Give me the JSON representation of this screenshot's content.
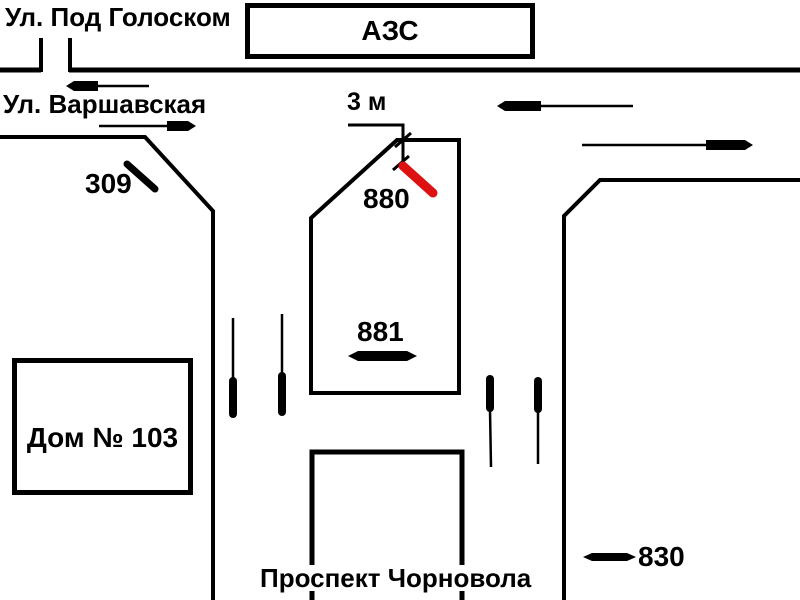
{
  "labels": {
    "street_top": "Ул. Под Голоском",
    "street_left": "Ул. Варшавская",
    "gas_station": "АЗС",
    "dimension": "3 м",
    "house": "Дом № 103",
    "avenue": "Проспект Чорновола"
  },
  "billboards": [
    {
      "id": "309",
      "orientation": "diagonal",
      "color": "#000000",
      "highlighted": false
    },
    {
      "id": "880",
      "orientation": "diagonal",
      "color": "#dd1111",
      "highlighted": true
    },
    {
      "id": "881",
      "orientation": "horizontal",
      "color": "#000000",
      "highlighted": false
    },
    {
      "id": "830",
      "orientation": "horizontal",
      "color": "#000000",
      "highlighted": false
    }
  ],
  "colors": {
    "background": "#ffffff",
    "line": "#000000",
    "highlight": "#dd1111"
  }
}
